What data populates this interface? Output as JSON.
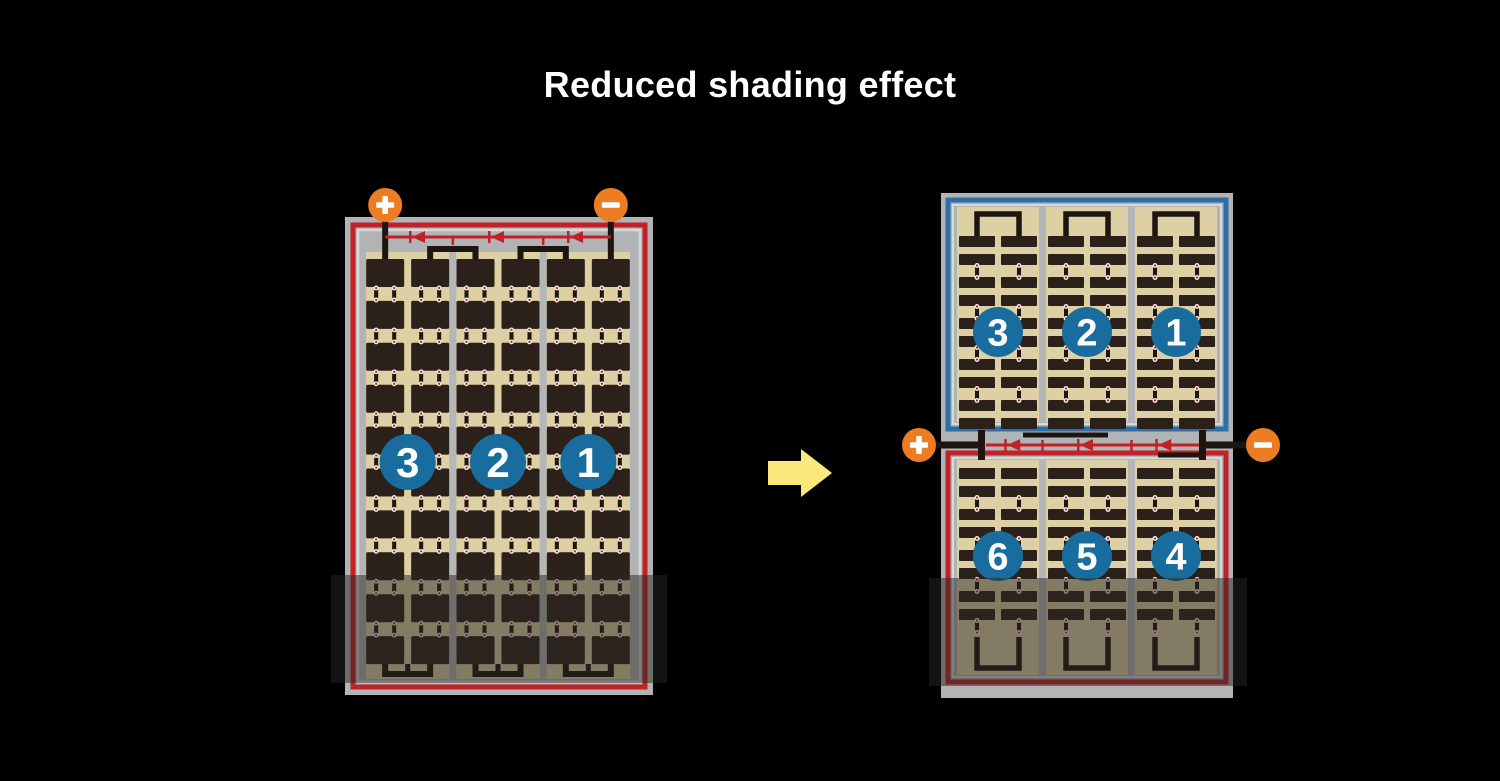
{
  "title": "Reduced shading effect",
  "colors": {
    "background": "#000000",
    "title_text": "#ffffff",
    "frame": "#b2b3b5",
    "frame_highlight": "#d7d8da",
    "panel_tan": "#ddd0a4",
    "cell_dark": "#2b211a",
    "separator": "#b5b6b8",
    "red_accent": "#c22126",
    "blue_accent": "#2f6fa8",
    "badge_blue": "#186d9e",
    "badge_text": "#ffffff",
    "terminal_orange": "#ed7d23",
    "terminal_symbol": "#ffffff",
    "arrow_yellow": "#f9e87a",
    "bus_black": "#1c1510",
    "diode_red": "#c22126",
    "dot_red": "#b3202a",
    "dot_ring": "#f6f1e3",
    "shade_overlay": "rgba(42,38,34,0.5)"
  },
  "left_module": {
    "terminals": {
      "positive": "+",
      "negative": "−"
    },
    "string_labels": [
      "3",
      "2",
      "1"
    ],
    "strings": 3,
    "cell_columns": 6,
    "cell_rows": 10,
    "diode_arrows": 3,
    "border": "red_accent",
    "shading_position": "bottom"
  },
  "transition": {
    "direction": "right"
  },
  "right_module": {
    "terminals": {
      "positive": "+",
      "negative": "−"
    },
    "top_half": {
      "border": "blue_accent",
      "string_labels": [
        "3",
        "2",
        "1"
      ]
    },
    "bottom_half": {
      "border": "red_accent",
      "string_labels": [
        "6",
        "5",
        "4"
      ]
    },
    "diode_arrows": 3,
    "shading_position": "bottom"
  }
}
